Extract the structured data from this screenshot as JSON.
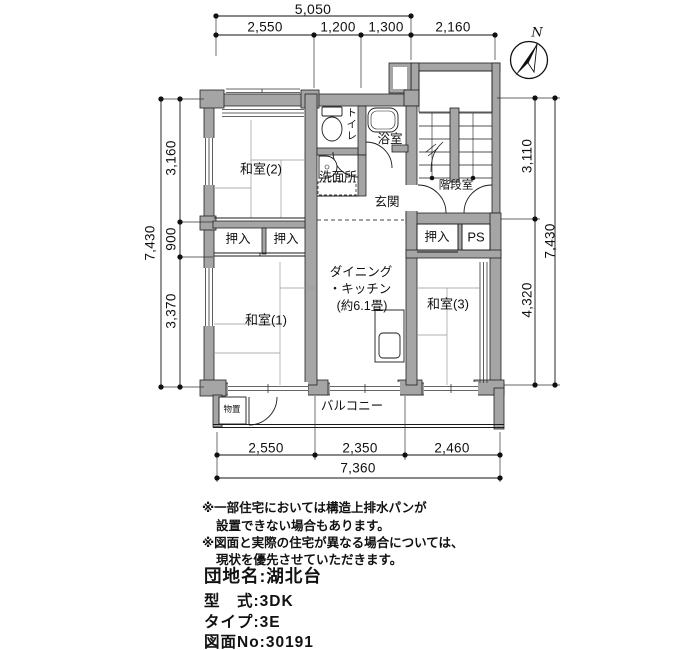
{
  "compass": {
    "north_label": "N"
  },
  "dimensions": {
    "top": {
      "total": "5,050",
      "segments": [
        "2,550",
        "1,200",
        "1,300"
      ],
      "stair_width": "2,160"
    },
    "left": {
      "total": "7,430",
      "segments": [
        "3,160",
        "900",
        "3,370"
      ]
    },
    "right": {
      "total": "7,430",
      "segments": [
        "3,110",
        "4,320"
      ]
    },
    "bottom": {
      "total": "7,360",
      "segments": [
        "2,550",
        "2,350",
        "2,460"
      ]
    }
  },
  "rooms": {
    "washitsu2": "和室(2)",
    "washitsu1": "和室(1)",
    "washitsu3": "和室(3)",
    "dining_kitchen_line1": "ダイニング",
    "dining_kitchen_line2": "・キッチン",
    "dining_kitchen_line3": "(約6.1畳)",
    "toilet": "トイレ",
    "bath": "浴室",
    "washroom": "洗面所",
    "entrance": "玄関",
    "stairwell": "階段室",
    "closet_left1": "押入",
    "closet_left2": "押入",
    "closet_right": "押入",
    "pipe_space": "PS",
    "balcony": "バルコニー",
    "storage": "物置"
  },
  "notes": [
    "※一部住宅においては構造上排水パンが",
    "設置できない場合もあります。",
    "※図面と実際の住宅が異なる場合については、",
    "現状を優先させていただきます。"
  ],
  "property": {
    "estate": "団地名:湖北台",
    "model": "型　式:3DK",
    "type": "タイプ:3E",
    "drawing_no": "図面No:30191"
  },
  "colors": {
    "wall": "#a5a5a5",
    "line": "#1a1a1a",
    "background": "#ffffff"
  }
}
